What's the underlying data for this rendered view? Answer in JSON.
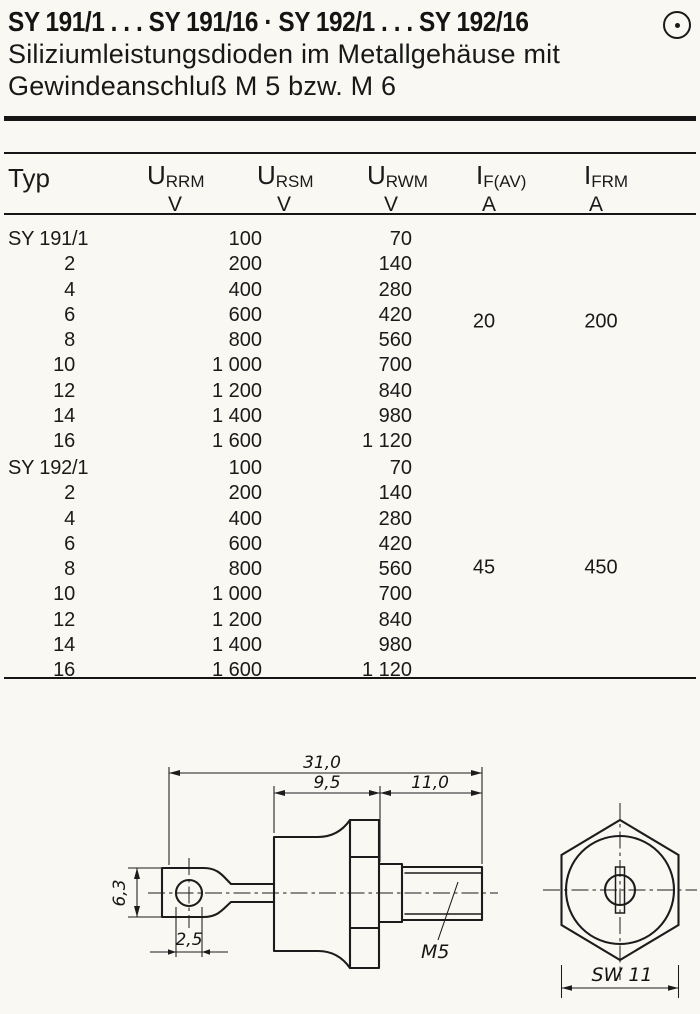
{
  "page": {
    "title": "SY 191/1 . . . SY 191/16 · SY 192/1 . . . SY 192/16",
    "subtitle_line1": "Siliziumleistungsdioden im Metallgehäuse mit",
    "subtitle_line2": "Gewindeanschluß M 5 bzw. M 6",
    "corner_symbol": "circle-dot"
  },
  "table": {
    "headers": {
      "typ": "Typ",
      "cols": [
        {
          "sym": "U",
          "sub": "RRM",
          "unit": "V"
        },
        {
          "sym": "U",
          "sub": "RSM",
          "unit": "V"
        },
        {
          "sym": "U",
          "sub": "RWM",
          "unit": "V"
        },
        {
          "sym": "I",
          "sub": "F(AV)",
          "unit": "A"
        },
        {
          "sym": "I",
          "sub": "FRM",
          "unit": "A"
        }
      ]
    },
    "sections": [
      {
        "name": "SY 191",
        "if_av": "20",
        "ifrm": "200",
        "rows": [
          {
            "typ": "SY 191/1",
            "urrm": "100",
            "urwm": "70"
          },
          {
            "typ": "2",
            "urrm": "200",
            "urwm": "140"
          },
          {
            "typ": "4",
            "urrm": "400",
            "urwm": "280"
          },
          {
            "typ": "6",
            "urrm": "600",
            "urwm": "420"
          },
          {
            "typ": "8",
            "urrm": "800",
            "urwm": "560"
          },
          {
            "typ": "10",
            "urrm": "1 000",
            "urwm": "700"
          },
          {
            "typ": "12",
            "urrm": "1 200",
            "urwm": "840"
          },
          {
            "typ": "14",
            "urrm": "1 400",
            "urwm": "980"
          },
          {
            "typ": "16",
            "urrm": "1 600",
            "urwm": "1 120"
          }
        ]
      },
      {
        "name": "SY 192",
        "if_av": "45",
        "ifrm": "450",
        "rows": [
          {
            "typ": "SY 192/1",
            "urrm": "100",
            "urwm": "70"
          },
          {
            "typ": "2",
            "urrm": "200",
            "urwm": "140"
          },
          {
            "typ": "4",
            "urrm": "400",
            "urwm": "280"
          },
          {
            "typ": "6",
            "urrm": "600",
            "urwm": "420"
          },
          {
            "typ": "8",
            "urrm": "800",
            "urwm": "560"
          },
          {
            "typ": "10",
            "urrm": "1 000",
            "urwm": "700"
          },
          {
            "typ": "12",
            "urrm": "1 200",
            "urwm": "840"
          },
          {
            "typ": "14",
            "urrm": "1 400",
            "urwm": "980"
          },
          {
            "typ": "16",
            "urrm": "1 600",
            "urwm": "1 120"
          }
        ]
      }
    ]
  },
  "drawing": {
    "side_view": {
      "dim_total_length": "31,0",
      "dim_case_length": "9,5",
      "dim_stud_length": "11,0",
      "dim_tab_width": "6,3",
      "dim_hole_dia": "2,5",
      "thread_label": "M5"
    },
    "end_view": {
      "dim_across_flats": "SW 11"
    }
  },
  "colors": {
    "paper": "#f9f8f3",
    "ink": "#1a1a1a"
  }
}
